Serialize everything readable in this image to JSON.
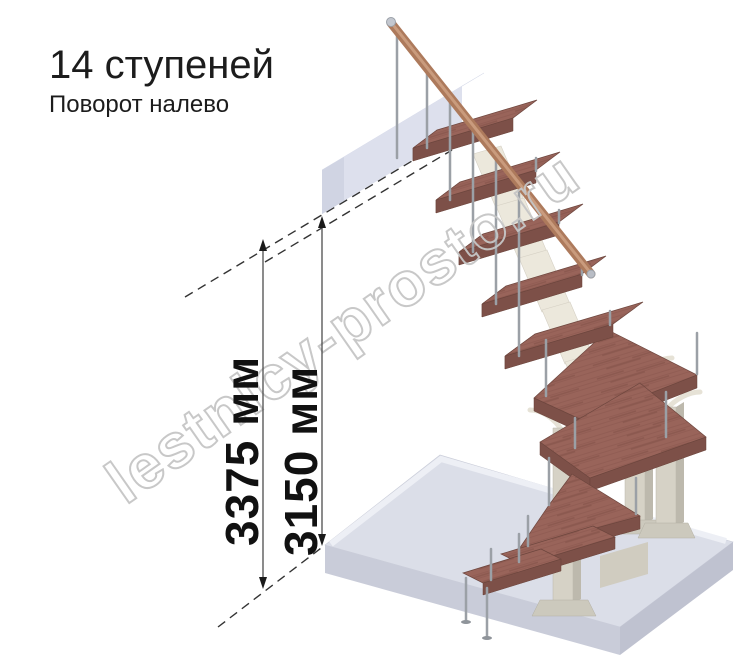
{
  "header": {
    "title": "14 ступеней",
    "subtitle": "Поворот налево"
  },
  "watermark": {
    "text": "lestnicy-prosto.ru",
    "color": "#c6c6c6"
  },
  "dimensions": {
    "total_height": {
      "label": "3375 мм",
      "value": 3375,
      "unit": "мм"
    },
    "clear_height": {
      "label": "3150 мм",
      "value": 3150,
      "unit": "мм"
    }
  },
  "stair": {
    "steps_count": 14,
    "turn_direction": "налево"
  },
  "colors": {
    "tread_wood": "#99645a",
    "handrail_wood": "#ad7a5c",
    "metal_baluster": "#9ba0a6",
    "support_column": "#d6d2c6",
    "floor_slab": "#dbdee8",
    "landing_slab": "#e3e6f2",
    "dimension_text": "#111111"
  }
}
